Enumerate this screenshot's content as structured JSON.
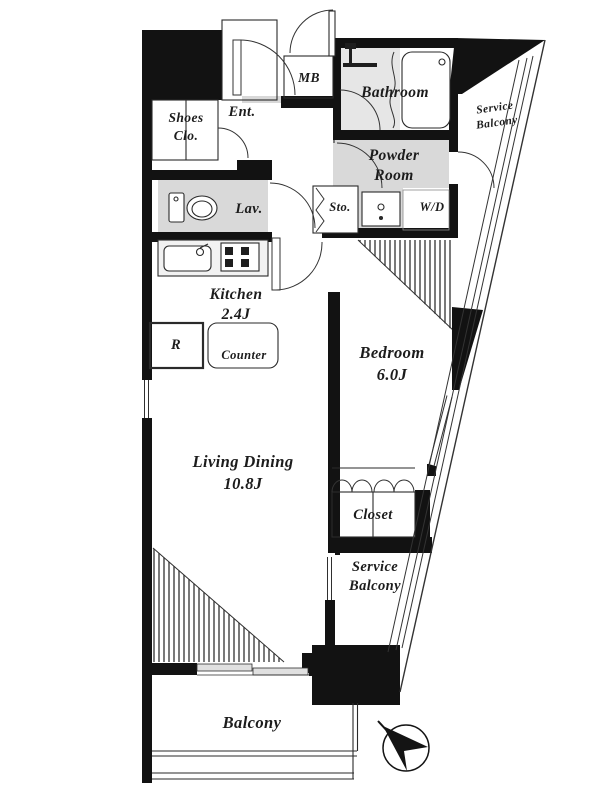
{
  "rooms": {
    "shoes_closet": {
      "line1": "Shoes",
      "line2": "Clo."
    },
    "entrance": {
      "label": "Ent."
    },
    "meter_box": {
      "label": "MB"
    },
    "bathroom": {
      "label": "Bathroom"
    },
    "service_balcony_top": {
      "line1": "Service",
      "line2": "Balcony"
    },
    "powder_room": {
      "line1": "Powder",
      "line2": "Room"
    },
    "lavatory": {
      "label": "Lav."
    },
    "storage": {
      "label": "Sto."
    },
    "washer_dryer": {
      "label": "W/D"
    },
    "kitchen": {
      "label": "Kitchen",
      "size": "2.4J"
    },
    "refrigerator": {
      "label": "R"
    },
    "counter": {
      "label": "Counter"
    },
    "bedroom": {
      "label": "Bedroom",
      "size": "6.0J"
    },
    "living_dining": {
      "label": "Living Dining",
      "size": "10.8J"
    },
    "closet": {
      "label": "Closet"
    },
    "service_balcony_bottom": {
      "line1": "Service",
      "line2": "Balcony"
    },
    "balcony": {
      "label": "Balcony"
    }
  },
  "colors": {
    "wall": "#121212",
    "room_gray": "#d9d9d9",
    "line": "#2f2f2f"
  }
}
